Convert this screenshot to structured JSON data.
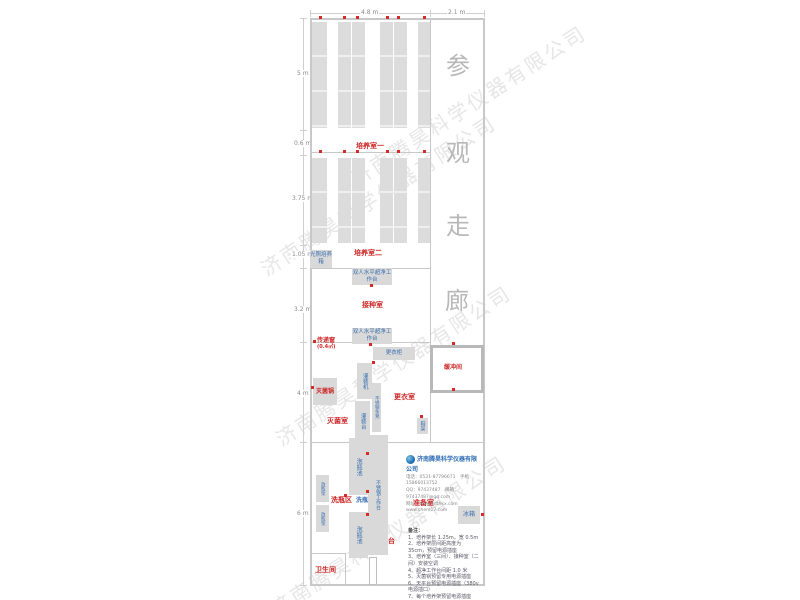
{
  "watermark": "济南腾昊科学仪器有限公司",
  "dimensions": {
    "top": [
      "4.8 m",
      "2.1 m"
    ],
    "left": [
      "5 m",
      "0.6 m",
      "3.75 m",
      "1.05 m",
      "3.2 m",
      "4 m",
      "6 m"
    ]
  },
  "corridor_chars": [
    "参",
    "观",
    "走",
    "廊"
  ],
  "rooms": {
    "room1": "培养室一",
    "room2": "培养室二",
    "inoculation": "接种室",
    "sterilization": "灭菌室",
    "changing": "更衣室",
    "buffer": "缓冲间",
    "washing_area": "洗瓶区",
    "prep": "准备室",
    "toilet": "卫生间"
  },
  "equipment": {
    "light_incubator": "光照培养箱",
    "clean_bench": "双人水平超净工作台",
    "wardrobe": "更衣柜",
    "filling_machine": "灌装机",
    "filling_table": "灌装台",
    "steel_bench": "不锈钢条凳",
    "sterilizer": "灭菌锅",
    "shoe_rack": "鞋架",
    "soak_pool": "泡瓶池",
    "bottle_washer": "洗瓶机",
    "steel_worktable": "不锈钢工作台",
    "bottle_rack": "放瓶架",
    "fridge": "冰箱",
    "balance_table": "天平台",
    "pass_window": "传递窗",
    "pass_window_area": "(0.4㎡)"
  },
  "company": {
    "name": "济南腾昊科学仪器有限公司",
    "tel_line": "电话：0531-87796671　手机：15866013752",
    "qq_line": "QQ：97437487　邮箱：97437487@qq.com",
    "web_line": "网址：www.sdthkx.com　www.chem17.com"
  },
  "notes": {
    "title": "备注：",
    "items": [
      "1、培养架长 1.25m，宽 0.5m",
      "2、培养架层间距高度为 35cm，预留电源插座",
      "3、培养室（三间）、接种室（二间）安装空调",
      "4、超净工作台间距 1.0 米",
      "5、灭菌锅预留专用电源插座",
      "6、天平台预留电源插座（380v 电源插口）",
      "7、每个培养架预留电源插座（×700w 左右）",
      "8、培养架靠近门侧预留间隔一米，方便小推车通过。"
    ]
  }
}
